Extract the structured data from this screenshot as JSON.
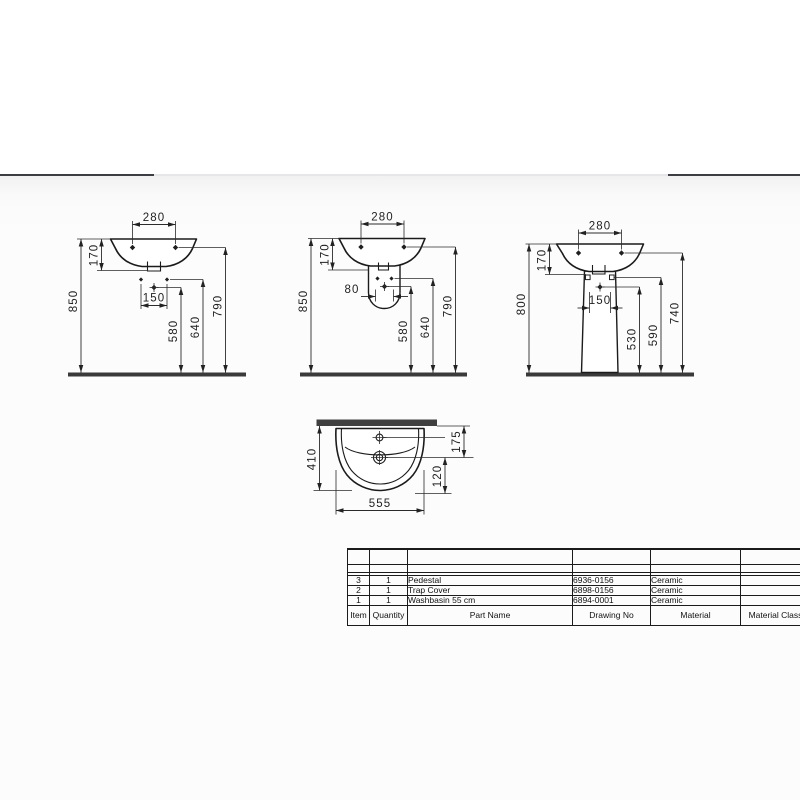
{
  "views": {
    "wall_hung": {
      "tap_span": "280",
      "rim_drop": "170",
      "height": "850",
      "hole_span": "150",
      "h_center": "580",
      "h_holes": "640",
      "h_rim": "790"
    },
    "semi_pedestal": {
      "tap_span": "280",
      "rim_drop": "170",
      "height": "850",
      "hole_span": "80",
      "h_center": "580",
      "h_holes": "640",
      "h_rim": "790"
    },
    "pedestal": {
      "tap_span": "280",
      "rim_drop": "170",
      "height": "800",
      "hole_span": "150",
      "h_center": "530",
      "h_holes": "590",
      "h_rim": "740"
    },
    "plan": {
      "depth": "410",
      "width": "555",
      "tap_offset": "175",
      "drain_offset": "120"
    }
  },
  "parts_table": {
    "headers": {
      "item": "Item",
      "qty": "Quantity",
      "part": "Part Name",
      "drawing": "Drawing No",
      "material": "Material",
      "material_class": "Material Class"
    },
    "rows": [
      {
        "item": "3",
        "qty": "1",
        "part": "Pedestal",
        "drawing": "6936-0156",
        "material": "Ceramic",
        "material_class": ""
      },
      {
        "item": "2",
        "qty": "1",
        "part": "Trap Cover",
        "drawing": "6898-0156",
        "material": "Ceramic",
        "material_class": ""
      },
      {
        "item": "1",
        "qty": "1",
        "part": "Washbasin 55 cm",
        "drawing": "6894-0001",
        "material": "Ceramic",
        "material_class": ""
      }
    ]
  }
}
